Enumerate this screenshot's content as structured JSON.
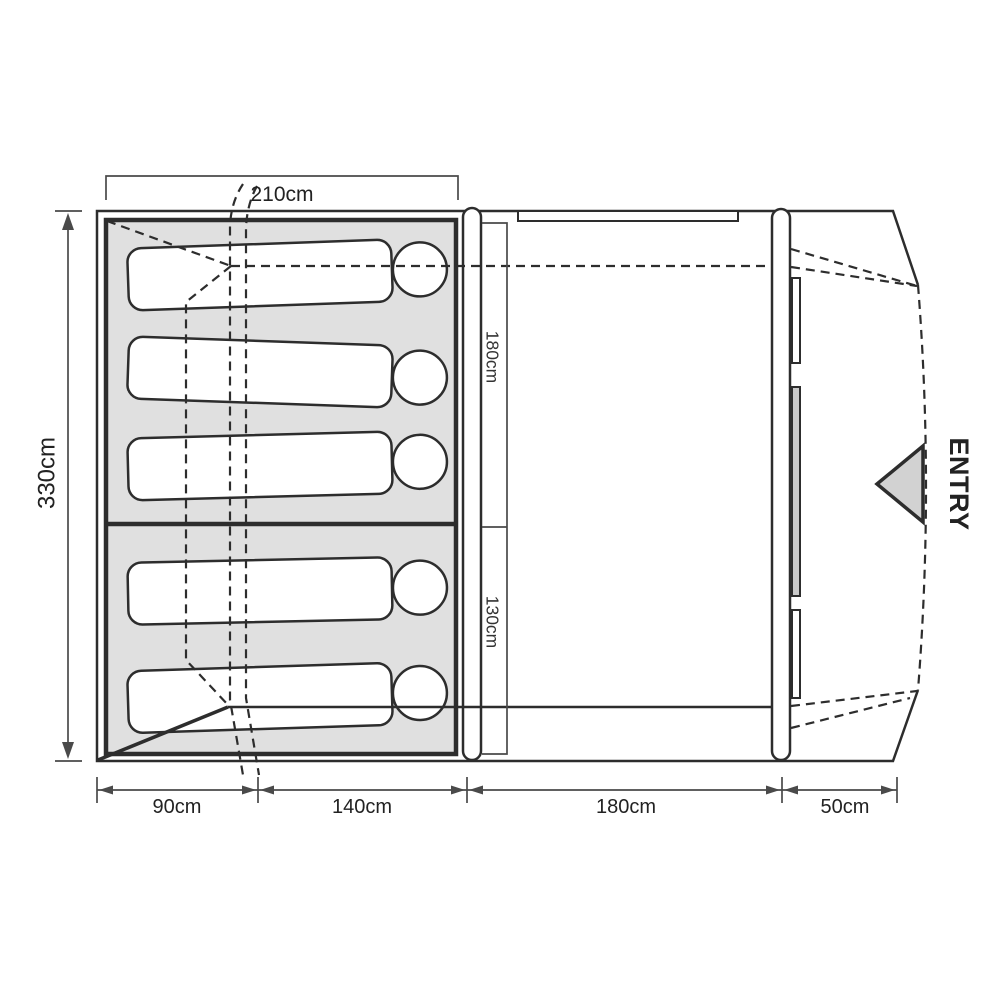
{
  "diagram": {
    "type": "tent-floorplan-top-view",
    "dimensions": {
      "top_width": "210cm",
      "side_depth": "330cm",
      "bedroom_main": "180cm",
      "bedroom_small": "130cm",
      "bottom": [
        "90cm",
        "140cm",
        "180cm",
        "50cm"
      ]
    },
    "entry_label": "ENTRY",
    "bedroom": {
      "sleepers_total": 5,
      "sections": [
        {
          "sleepers": 3,
          "depth_label": "180cm"
        },
        {
          "sleepers": 2,
          "depth_label": "130cm"
        }
      ]
    },
    "colors": {
      "line": "#2d2d2d",
      "dim": "#4a4a4a",
      "text": "#222222",
      "cabin": "#e0e0e0",
      "panel": "#c9c9c9",
      "arrow": "#d2d2d2"
    }
  }
}
